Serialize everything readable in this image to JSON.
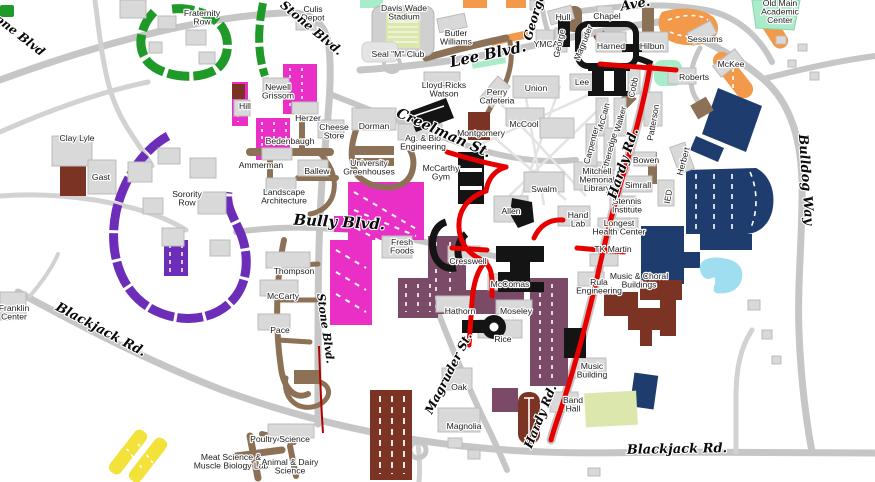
{
  "map": {
    "type": "campus-map",
    "building_labels": [
      {
        "lines": [
          "Fraternity",
          "Row"
        ],
        "x": 202,
        "y": 16
      },
      {
        "lines": [
          "Culis",
          "Depot"
        ],
        "x": 313,
        "y": 12
      },
      {
        "lines": [
          "Davis Wade",
          "Stadium"
        ],
        "x": 404,
        "y": 11
      },
      {
        "lines": [
          "Hull"
        ],
        "x": 563,
        "y": 20
      },
      {
        "lines": [
          "Chapel"
        ],
        "x": 607,
        "y": 19
      },
      {
        "lines": [
          "Old Main",
          "Academic",
          "Center"
        ],
        "x": 780,
        "y": 6
      },
      {
        "lines": [
          "Butler",
          "Williams"
        ],
        "x": 456,
        "y": 36
      },
      {
        "lines": [
          "Seal \"M\" Club"
        ],
        "x": 398,
        "y": 57
      },
      {
        "lines": [
          "YMCA"
        ],
        "x": 546,
        "y": 47
      },
      {
        "lines": [
          "George"
        ],
        "x": 562,
        "y": 44,
        "rotate": -78
      },
      {
        "lines": [
          "Magruder"
        ],
        "x": 586,
        "y": 44,
        "rotate": -68
      },
      {
        "lines": [
          "Harned"
        ],
        "x": 611,
        "y": 49
      },
      {
        "lines": [
          "Hilbun"
        ],
        "x": 652,
        "y": 49
      },
      {
        "lines": [
          "Sessums"
        ],
        "x": 705,
        "y": 42
      },
      {
        "lines": [
          "McKee"
        ],
        "x": 731,
        "y": 67
      },
      {
        "lines": [
          "Roberts"
        ],
        "x": 694,
        "y": 80
      },
      {
        "lines": [
          "Lee"
        ],
        "x": 582,
        "y": 85
      },
      {
        "lines": [
          "Union"
        ],
        "x": 536,
        "y": 91
      },
      {
        "lines": [
          "Cobb"
        ],
        "x": 636,
        "y": 88,
        "rotate": -78
      },
      {
        "lines": [
          "McCain"
        ],
        "x": 606,
        "y": 118,
        "rotate": -75
      },
      {
        "lines": [
          "Walker"
        ],
        "x": 623,
        "y": 120,
        "rotate": -75
      },
      {
        "lines": [
          "Carpenter"
        ],
        "x": 594,
        "y": 146,
        "rotate": -75
      },
      {
        "lines": [
          "Etheredge"
        ],
        "x": 612,
        "y": 153,
        "rotate": -75
      },
      {
        "lines": [
          "Patterson"
        ],
        "x": 656,
        "y": 123,
        "rotate": -80
      },
      {
        "lines": [
          "Perry",
          "Cafeteria"
        ],
        "x": 497,
        "y": 95
      },
      {
        "lines": [
          "McCool"
        ],
        "x": 524,
        "y": 127
      },
      {
        "lines": [
          "Montgomery"
        ],
        "x": 481,
        "y": 136
      },
      {
        "lines": [
          "Lloyd-Ricks",
          "Watson"
        ],
        "x": 444,
        "y": 88
      },
      {
        "lines": [
          "Mitchell",
          "Memorial",
          "Library"
        ],
        "x": 597,
        "y": 174
      },
      {
        "lines": [
          "Swalm"
        ],
        "x": 544,
        "y": 192
      },
      {
        "lines": [
          "Allen"
        ],
        "x": 511,
        "y": 214
      },
      {
        "lines": [
          "Hand",
          "Lab"
        ],
        "x": 578,
        "y": 218
      },
      {
        "lines": [
          "Stennis",
          "Institute"
        ],
        "x": 627,
        "y": 204
      },
      {
        "lines": [
          "Longest",
          "Health Center"
        ],
        "x": 619,
        "y": 226
      },
      {
        "lines": [
          "TK Martin"
        ],
        "x": 613,
        "y": 252
      },
      {
        "lines": [
          "Simrall"
        ],
        "x": 638,
        "y": 188
      },
      {
        "lines": [
          "Bowen"
        ],
        "x": 646,
        "y": 163
      },
      {
        "lines": [
          "Herbert"
        ],
        "x": 686,
        "y": 162,
        "rotate": -75
      },
      {
        "lines": [
          "IED"
        ],
        "x": 671,
        "y": 197,
        "rotate": -80
      },
      {
        "lines": [
          "Music & Choral",
          "Buildings"
        ],
        "x": 639,
        "y": 279
      },
      {
        "lines": [
          "Rula",
          "Engineering"
        ],
        "x": 599,
        "y": 285
      },
      {
        "lines": [
          "Music",
          "Building"
        ],
        "x": 592,
        "y": 369
      },
      {
        "lines": [
          "Band",
          "Hall"
        ],
        "x": 573,
        "y": 403
      },
      {
        "lines": [
          "McComas"
        ],
        "x": 510,
        "y": 287
      },
      {
        "lines": [
          "Moseley"
        ],
        "x": 516,
        "y": 314
      },
      {
        "lines": [
          "Rice"
        ],
        "x": 503,
        "y": 342
      },
      {
        "lines": [
          "Hathorn"
        ],
        "x": 460,
        "y": 314
      },
      {
        "lines": [
          "Cresswell"
        ],
        "x": 468,
        "y": 264
      },
      {
        "lines": [
          "Fresh",
          "Foods"
        ],
        "x": 402,
        "y": 245
      },
      {
        "lines": [
          "Oak"
        ],
        "x": 459,
        "y": 390
      },
      {
        "lines": [
          "Magnolia"
        ],
        "x": 464,
        "y": 429
      },
      {
        "lines": [
          "Thompson"
        ],
        "x": 294,
        "y": 274
      },
      {
        "lines": [
          "McCarty"
        ],
        "x": 283,
        "y": 299
      },
      {
        "lines": [
          "Pace"
        ],
        "x": 280,
        "y": 333
      },
      {
        "lines": [
          "Newell",
          "Grissom"
        ],
        "x": 278,
        "y": 90
      },
      {
        "lines": [
          "Hill"
        ],
        "x": 245,
        "y": 109
      },
      {
        "lines": [
          "Herzer"
        ],
        "x": 308,
        "y": 121
      },
      {
        "lines": [
          "Cheese",
          "Store"
        ],
        "x": 334,
        "y": 130
      },
      {
        "lines": [
          "Bedenbaugh"
        ],
        "x": 290,
        "y": 144
      },
      {
        "lines": [
          "Ammerman"
        ],
        "x": 261,
        "y": 168
      },
      {
        "lines": [
          "Ballew"
        ],
        "x": 317,
        "y": 174
      },
      {
        "lines": [
          "Dorman"
        ],
        "x": 374,
        "y": 129
      },
      {
        "lines": [
          "University",
          "Greenhouses"
        ],
        "x": 369,
        "y": 166
      },
      {
        "lines": [
          "Ag. & Bio",
          "Engineering"
        ],
        "x": 423,
        "y": 141
      },
      {
        "lines": [
          "Landscape",
          "Architecture"
        ],
        "x": 284,
        "y": 195
      },
      {
        "lines": [
          "McCarthy",
          "Gym"
        ],
        "x": 441,
        "y": 171
      },
      {
        "lines": [
          "Sorority",
          "Row"
        ],
        "x": 187,
        "y": 197
      },
      {
        "lines": [
          "Franklin",
          "Center"
        ],
        "x": 14,
        "y": 311
      },
      {
        "lines": [
          "Poultry Science"
        ],
        "x": 280,
        "y": 442
      },
      {
        "lines": [
          "Meat Science &",
          "Muscle Biology Lab"
        ],
        "x": 231,
        "y": 460
      },
      {
        "lines": [
          "Animal & Dairy",
          "Science"
        ],
        "x": 290,
        "y": 465
      },
      {
        "lines": [
          "Clay Lyle"
        ],
        "x": 77,
        "y": 141
      },
      {
        "lines": [
          "Gast"
        ],
        "x": 101,
        "y": 180
      }
    ],
    "street_labels": [
      {
        "text": "Stone Blvd",
        "x": 12,
        "y": 34,
        "rotate": 38,
        "size": 12
      },
      {
        "text": "Stone Blvd.",
        "x": 309,
        "y": 31,
        "rotate": 40,
        "size": 12
      },
      {
        "text": "Stone Blvd.",
        "x": 322,
        "y": 329,
        "rotate": 82,
        "size": 11
      },
      {
        "text": "Lee Blvd.",
        "x": 489,
        "y": 59,
        "rotate": -12,
        "size": 15
      },
      {
        "text": "Creelman St.",
        "x": 442,
        "y": 137,
        "rotate": 24,
        "size": 14
      },
      {
        "text": "Bully Blvd.",
        "x": 339,
        "y": 227,
        "rotate": 3,
        "size": 15
      },
      {
        "text": "Blackjack Rd.",
        "x": 99,
        "y": 333,
        "rotate": 28,
        "size": 13
      },
      {
        "text": "Blackjack Rd.",
        "x": 677,
        "y": 453,
        "rotate": -1,
        "size": 13
      },
      {
        "text": "Hardy Rd.",
        "x": 627,
        "y": 165,
        "rotate": -72,
        "size": 13
      },
      {
        "text": "Hardy Rd.",
        "x": 544,
        "y": 418,
        "rotate": -68,
        "size": 12
      },
      {
        "text": "Magruder St.",
        "x": 452,
        "y": 375,
        "rotate": -63,
        "size": 12
      },
      {
        "text": "Bulldog Way",
        "x": 802,
        "y": 180,
        "rotate": 86,
        "size": 13
      },
      {
        "text": "George",
        "x": 538,
        "y": 18,
        "rotate": -73,
        "size": 12
      },
      {
        "text": "Ave.",
        "x": 636,
        "y": 8,
        "rotate": -10,
        "size": 13
      }
    ],
    "colors": {
      "background": "#ffffff",
      "road": "#c6c6c6",
      "road_minor": "#d2d2d2",
      "path_light": "#e3e3e3",
      "building": "#d9d9d9",
      "building_outline": "#bcbcbc",
      "building_dark": "#141414",
      "route_red": "#e80000",
      "route_dark_red": "#b00000",
      "lot_green": "#1f9a28",
      "lot_magenta": "#ea2fc7",
      "lot_purple": "#6c2eb8",
      "lot_plum": "#7b4a66",
      "lot_orange": "#f2994a",
      "lot_navy": "#1e3c6d",
      "lot_yellow": "#f2e23a",
      "service_brown": "#8c7156",
      "maroon": "#7b3323",
      "mint": "#a9ecca",
      "pond": "#9fdef1",
      "field": "#dbe7ad",
      "label": "#1c1c1c"
    }
  }
}
